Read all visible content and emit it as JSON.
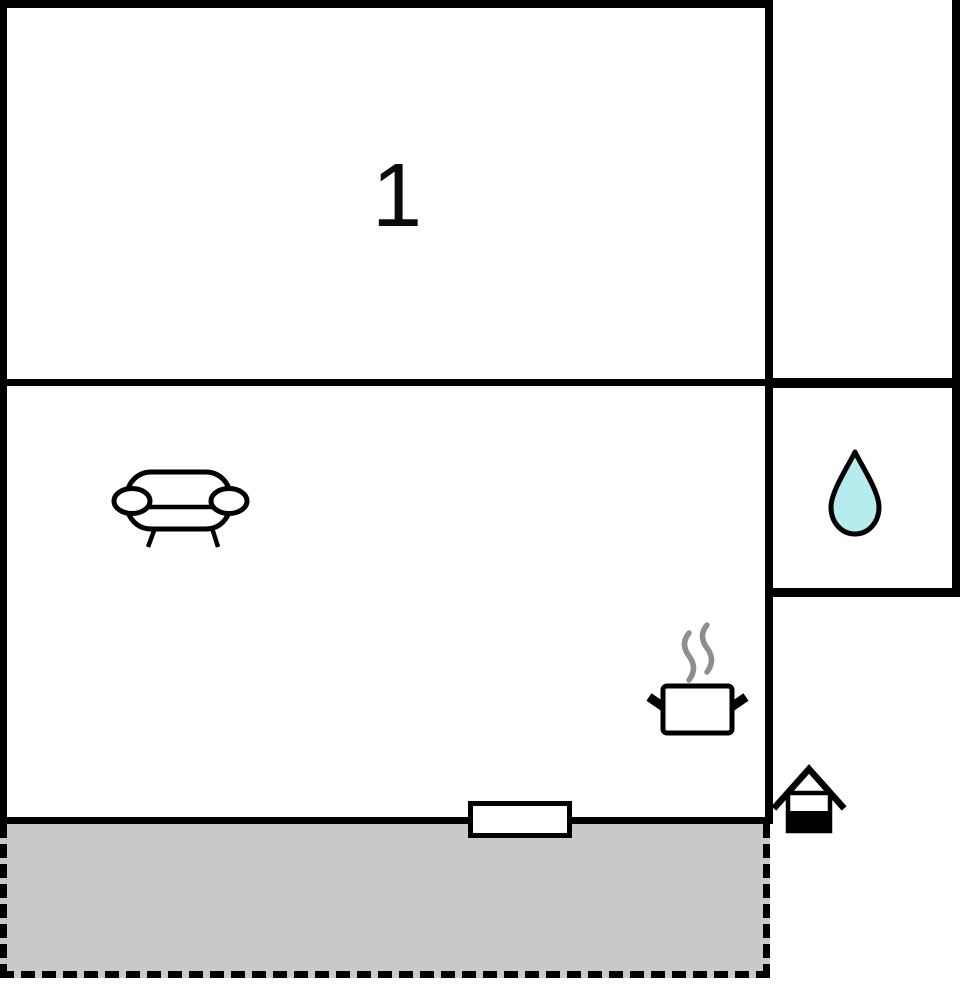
{
  "rooms": {
    "bedroom": {
      "label": "1",
      "icons": []
    },
    "living_room": {
      "label": "",
      "icons": [
        "sofa-icon",
        "cooking-pot-icon"
      ]
    },
    "bathroom": {
      "label": "",
      "icons": [
        "water-drop-icon"
      ]
    },
    "terrace": {
      "label": "",
      "icons": []
    }
  },
  "markers": {
    "window": "window-marker",
    "entrance": "entrance-house-icon"
  },
  "colors": {
    "wall": "#000000",
    "room_fill": "#ffffff",
    "terrace_fill": "#c9c9c9",
    "drop_fill": "#b5edef",
    "steam_stroke": "#8e8e8e",
    "icon_stroke": "#000000"
  }
}
